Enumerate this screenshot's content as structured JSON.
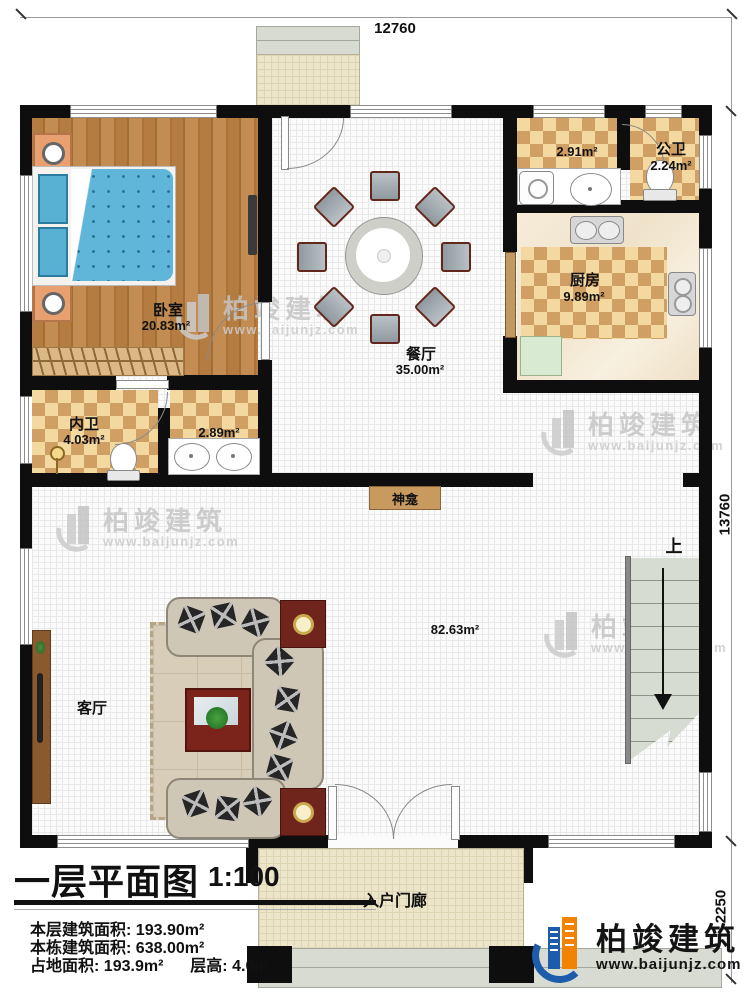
{
  "plan": {
    "dimensions": {
      "top": "12760",
      "right_upper": "13760",
      "right_lower": "2250"
    },
    "rooms": {
      "bedroom": {
        "name": "卧室",
        "area": "20.83m²"
      },
      "dining": {
        "name": "餐厅",
        "area": "35.00m²"
      },
      "public_bath": {
        "name": "公卫",
        "area": "2.24m²"
      },
      "laundry_area": {
        "area": "2.91m²"
      },
      "kitchen": {
        "name": "厨房",
        "area": "9.89m²"
      },
      "ensuite_bath": {
        "name": "内卫",
        "area": "4.03m²"
      },
      "vanity_area": {
        "area": "2.89m²"
      },
      "hall_area": {
        "area": "82.63m²"
      },
      "living": {
        "name": "客厅"
      },
      "shrine": {
        "name": "神龛"
      },
      "entry_porch": {
        "name": "入户门廊"
      }
    },
    "stairs": {
      "direction_label": "上"
    }
  },
  "title_block": {
    "title": "一层平面图",
    "scale": "1:100",
    "rows": [
      {
        "label": "本层建筑面积:",
        "value": "193.90m²"
      },
      {
        "label": "本栋建筑面积:",
        "value": "638.00m²"
      },
      {
        "label": "占地面积:",
        "value": "193.9m²",
        "label2": "层高:",
        "value2": "4.0m"
      }
    ]
  },
  "branding": {
    "company": "柏竣建筑",
    "website": "www.baijunjz.com"
  },
  "watermark": {
    "company": "柏竣建筑",
    "website": "www.baijunjz.com"
  },
  "colors": {
    "wall": "#0e0e0e",
    "tile_dark": "#cf9f63",
    "tile_light": "#f3d89f",
    "wood": "#b0793f",
    "brand_blue": "#1d5cab",
    "brand_orange": "#f08300"
  }
}
